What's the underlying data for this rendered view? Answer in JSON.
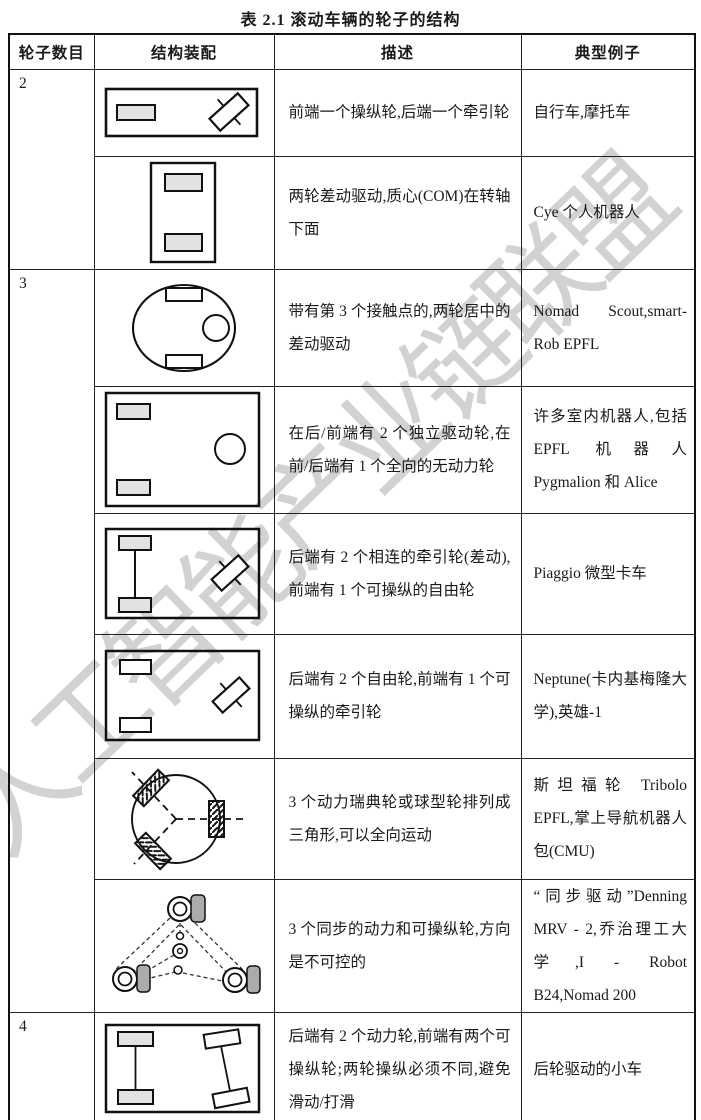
{
  "title": "表 2.1  滚动车辆的轮子的结构",
  "watermark": {
    "text": "人工智能产业链联盟",
    "color": "#cbcbcb"
  },
  "colors": {
    "border": "#222222",
    "text": "#1a1a1a",
    "wheel_shaded": "#e2e2e2",
    "wheel_gray": "#ababab",
    "watermark_gray": "#cbcbcb"
  },
  "table": {
    "headers": [
      "轮子数目",
      "结构装配",
      "描述",
      "典型例子"
    ],
    "rows": [
      {
        "wheels": "2",
        "diagram": "two-wheel-bicycle-diagram",
        "description": "前端一个操纵轮,后端一个牵引轮",
        "examples": "自行车,摩托车"
      },
      {
        "diagram": "two-wheel-differential-com-diagram",
        "description": "两轮差动驱动,质心(COM)在转轴下面",
        "examples": "Cye 个人机器人"
      },
      {
        "wheels": "3",
        "diagram": "three-wheel-centered-differential-diagram",
        "description": "带有第 3 个接触点的,两轮居中的差动驱动",
        "examples": "Nomad Scout,smart-Rob EPFL"
      },
      {
        "diagram": "three-wheel-independent-drive-diagram",
        "description": "在后/前端有 2 个独立驱动轮,在前/后端有 1 个全向的无动力轮",
        "examples": "许多室内机器人,包括 EPFL 机器人 Pygmalion 和 Alice"
      },
      {
        "diagram": "three-wheel-connected-traction-diagram",
        "description": "后端有 2 个相连的牵引轮(差动),前端有 1 个可操纵的自由轮",
        "examples": "Piaggio 微型卡车"
      },
      {
        "diagram": "three-wheel-steered-traction-diagram",
        "description": "后端有 2 个自由轮,前端有 1 个可操纵的牵引轮",
        "examples": "Neptune(卡内基梅隆大学),英雄-1"
      },
      {
        "diagram": "three-swedish-wheels-triangle-diagram",
        "description": "3 个动力瑞典轮或球型轮排列成三角形,可以全向运动",
        "examples": "斯坦福轮 Tribolo EPFL,掌上导航机器人包(CMU)"
      },
      {
        "diagram": "three-wheel-synchro-drive-diagram",
        "description": "3 个同步的动力和可操纵轮,方向是不可控的",
        "examples": "“同步驱动”Denning MRV - 2,乔治理工大学,I - Robot B24,Nomad 200"
      },
      {
        "wheels": "4",
        "diagram": "four-wheel-rear-drive-diagram",
        "description": "后端有 2 个动力轮,前端有两个可操纵轮;两轮操纵必须不同,避免滑动/打滑",
        "examples": "后轮驱动的小车"
      }
    ]
  }
}
